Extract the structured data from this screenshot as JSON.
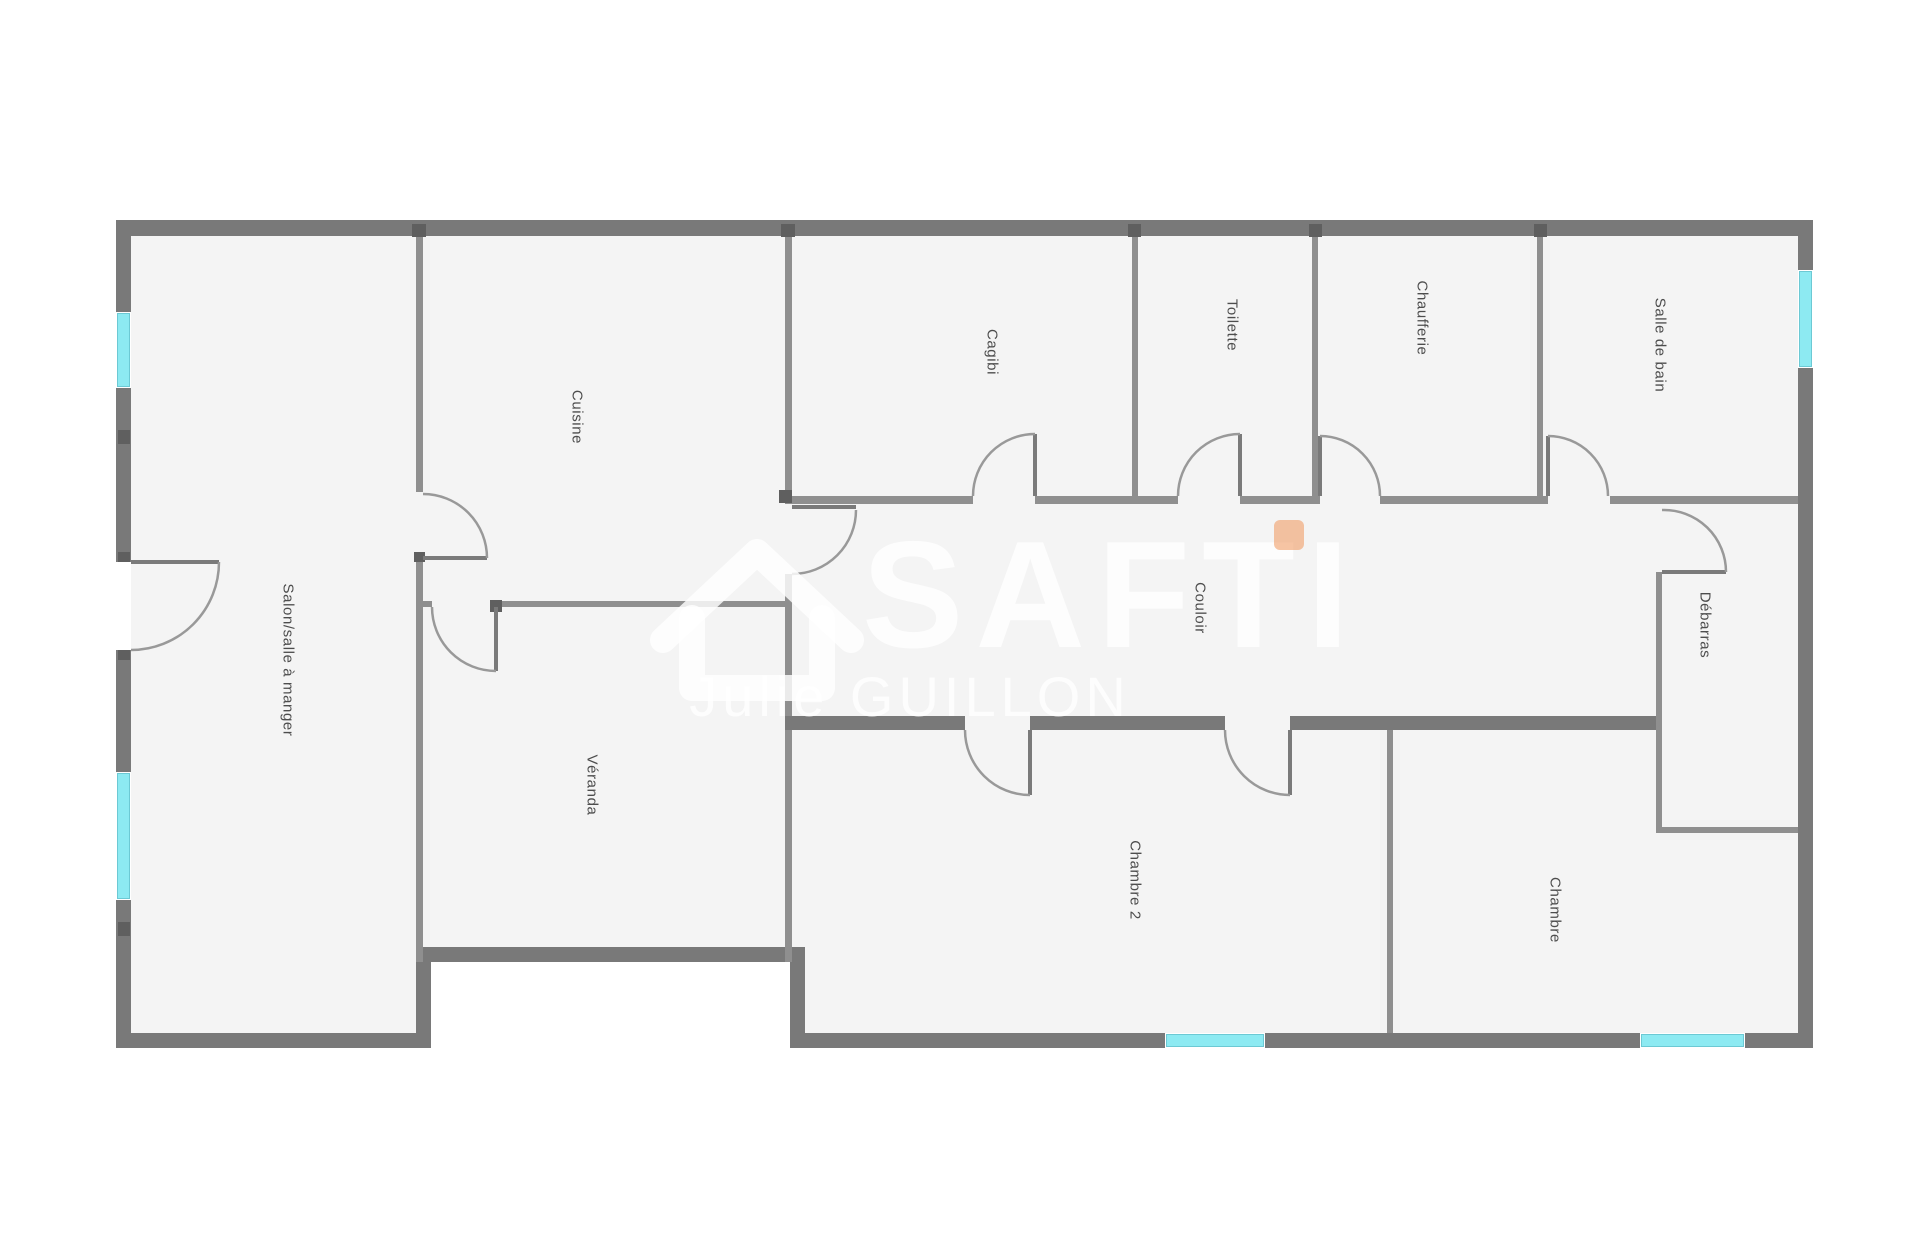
{
  "watermark": {
    "brand": "SAFTI",
    "agent_name": "Julie GUILLON"
  },
  "rooms": {
    "salon": {
      "label": "Salon/salle à manger"
    },
    "cuisine": {
      "label": "Cuisine"
    },
    "veranda": {
      "label": "Véranda"
    },
    "cagibi": {
      "label": "Cagibi"
    },
    "toilette": {
      "label": "Toilette"
    },
    "chaufferie": {
      "label": "Chaufferie"
    },
    "salle_de_bain": {
      "label": "Salle de bain"
    },
    "couloir": {
      "label": "Couloir"
    },
    "debarras": {
      "label": "Débarras"
    },
    "chambre2": {
      "label": "Chambre 2"
    },
    "chambre": {
      "label": "Chambre"
    }
  },
  "colors": {
    "exterior": "#ffffff",
    "floor": "#f4f4f4",
    "wall": "#797979",
    "interior_wall": "#8f8f8f",
    "nub": "#5f5f5f",
    "window": "#8deaf2",
    "window_edge": "#6cc9d4",
    "door_arc": "#999999",
    "leaf": "#7a7a7a",
    "label_text": "#4d4d4d",
    "watermark": "rgba(255,255,255,0.82)",
    "brand_dot": "rgba(240,150,90,0.55)"
  }
}
